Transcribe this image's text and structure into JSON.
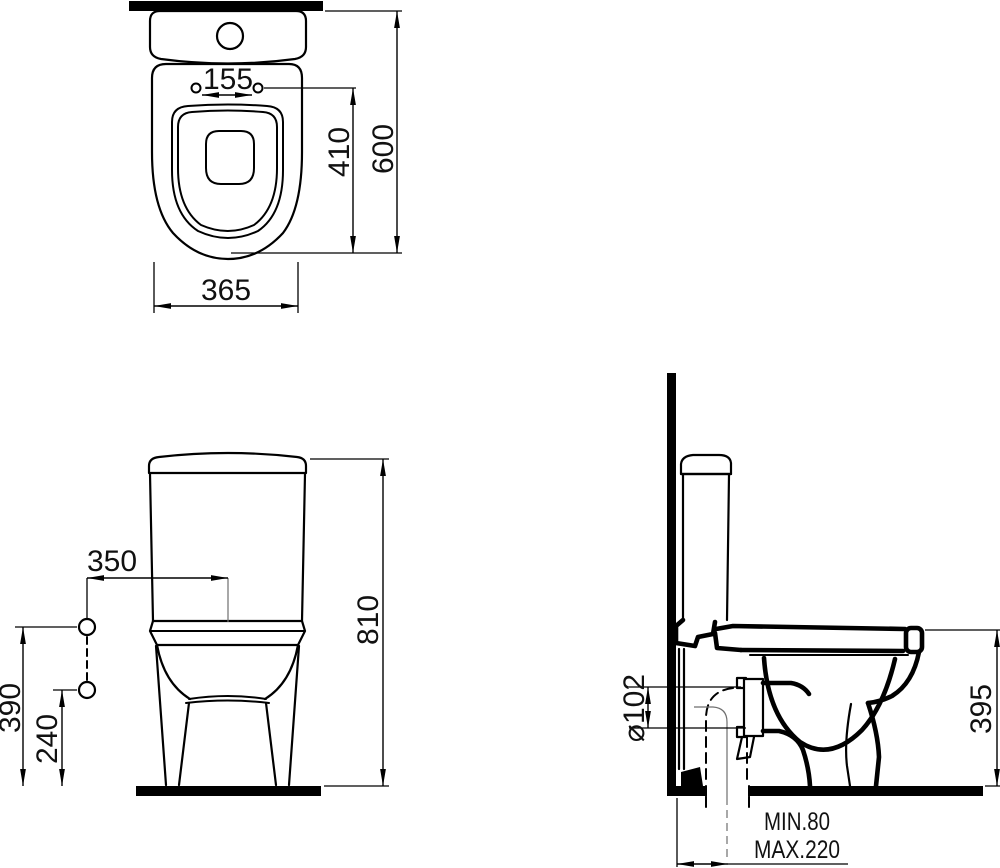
{
  "top_view": {
    "hole_spacing": "155",
    "bowl_depth": "410",
    "total_depth": "600",
    "width": "365"
  },
  "front_view": {
    "inlet_offset_horizontal": "350",
    "total_height": "810",
    "inlet_height_upper": "390",
    "inlet_height_lower": "240"
  },
  "side_view": {
    "outlet_diameter": "⌀102",
    "rim_height": "395",
    "outlet_distance_min": "MIN.80",
    "outlet_distance_max": "MAX.220"
  },
  "colors": {
    "line": "#000000",
    "background": "#ffffff",
    "centerline": "#6e6e6e"
  }
}
